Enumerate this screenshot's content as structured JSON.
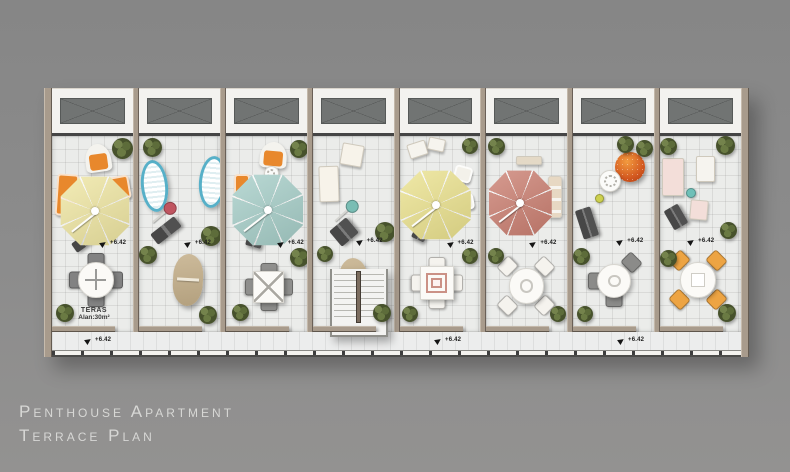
{
  "title": {
    "line1": "Penthouse Apartment",
    "line2": "Terrace Plan"
  },
  "elevation_label": "+6.42",
  "area_label": {
    "line1": "TERAS",
    "line2": "Alan:30m²"
  },
  "palette": {
    "background": "#8c8c8c",
    "wall": "#a89b8c",
    "floor": "#ebecea",
    "window": "#717473",
    "umbrella_yellow": "#efe6a2",
    "umbrella_teal": "#a6cec8",
    "umbrella_yellow2": "#ebe28e",
    "umbrella_salmon": "#cb7f71",
    "orange_furniture": "#e8882c",
    "sunbed_teal": "#57b0c8",
    "bench_gray": "#4f4f4f",
    "plant_green": "#47522c",
    "title_text": "#d7d7d5"
  },
  "walkway": {
    "markers": [
      {
        "x": 33
      },
      {
        "x": 383
      },
      {
        "x": 566
      }
    ]
  },
  "units": [
    {
      "name": "terrace-unit-1",
      "items": [
        {
          "type": "hooded",
          "name": "hooded-beach-chair",
          "x": 33,
          "y": 8,
          "w": 26,
          "h": 28,
          "rot": -8,
          "c": "#e8882c"
        },
        {
          "type": "plant",
          "name": "potted-plant",
          "x": 60,
          "y": 2,
          "w": 21,
          "h": 21
        },
        {
          "type": "chair",
          "name": "lounge-sofa",
          "x": 4,
          "y": 38,
          "w": 22,
          "h": 42,
          "rot": 4,
          "c": "#e8882c"
        },
        {
          "type": "chair",
          "name": "lounge-chair",
          "x": 58,
          "y": 40,
          "w": 20,
          "h": 24,
          "rot": -10,
          "c": "#e8882c"
        },
        {
          "type": "umbrella",
          "name": "patio-umbrella",
          "x": 8,
          "y": 40,
          "w": 70,
          "h": 70,
          "c": "#efe6a2"
        },
        {
          "type": "bench",
          "name": "bench",
          "x": 20,
          "y": 100,
          "w": 24,
          "h": 11,
          "rot": -35
        },
        {
          "type": "elev",
          "name": "elevation-marker",
          "x": 48,
          "y": 104,
          "label": "+6.42"
        },
        {
          "type": "table",
          "name": "dining-table-set",
          "shape": "round",
          "x": 18,
          "y": 118,
          "w": 52,
          "h": 52,
          "deco": "cross",
          "cc": "#828282",
          "chairs": [
            "n",
            "e",
            "s",
            "w"
          ]
        },
        {
          "type": "arealabel",
          "name": "area-label",
          "x": 18,
          "y": 171,
          "lines": [
            "TERAS",
            "Alan:30m²"
          ]
        },
        {
          "type": "plant",
          "name": "potted-plant",
          "x": 4,
          "y": 168,
          "w": 18,
          "h": 18
        }
      ]
    },
    {
      "name": "terrace-unit-2",
      "items": [
        {
          "type": "plant",
          "name": "potted-plant",
          "x": 4,
          "y": 2,
          "w": 19,
          "h": 19
        },
        {
          "type": "sunbed",
          "name": "sun-lounger",
          "x": 2,
          "y": 24,
          "w": 27,
          "h": 52,
          "rot": -6,
          "c": "#57b0c8"
        },
        {
          "type": "sunbed",
          "name": "sun-lounger",
          "x": 60,
          "y": 20,
          "w": 27,
          "h": 52,
          "rot": 5,
          "c": "#57b0c8"
        },
        {
          "type": "stand",
          "name": "parasol-stand",
          "x": 8,
          "y": 70,
          "w": 24,
          "h": 2,
          "rot": -40,
          "c": "#c05560"
        },
        {
          "type": "bench",
          "name": "bench",
          "x": 12,
          "y": 88,
          "w": 30,
          "h": 13,
          "rot": -38
        },
        {
          "type": "elev",
          "name": "elevation-marker",
          "x": 46,
          "y": 104,
          "label": "+6.42"
        },
        {
          "type": "plant",
          "name": "potted-plant",
          "x": 62,
          "y": 90,
          "w": 20,
          "h": 20
        },
        {
          "type": "plant",
          "name": "potted-plant",
          "x": 0,
          "y": 110,
          "w": 18,
          "h": 18
        },
        {
          "type": "board",
          "name": "surf-lounger",
          "x": 34,
          "y": 118,
          "w": 30,
          "h": 52,
          "rot": 3
        },
        {
          "type": "plant",
          "name": "potted-plant",
          "x": 60,
          "y": 170,
          "w": 18,
          "h": 18
        }
      ]
    },
    {
      "name": "terrace-unit-3",
      "items": [
        {
          "type": "hooded",
          "name": "hooded-beach-chair",
          "x": 34,
          "y": 6,
          "w": 27,
          "h": 26,
          "rot": 5,
          "c": "#e8882c"
        },
        {
          "type": "plant",
          "name": "potted-plant",
          "x": 64,
          "y": 4,
          "w": 18,
          "h": 18
        },
        {
          "type": "chair",
          "name": "lounge-chair",
          "x": 8,
          "y": 38,
          "w": 16,
          "h": 26,
          "c": "#e8882c"
        },
        {
          "type": "flowertable",
          "name": "side-table",
          "x": 38,
          "y": 30,
          "w": 15,
          "h": 15
        },
        {
          "type": "umbrella",
          "name": "patio-umbrella",
          "x": 6,
          "y": 38,
          "w": 72,
          "h": 72,
          "c": "#a6cec8"
        },
        {
          "type": "bench",
          "name": "bench",
          "x": 20,
          "y": 102,
          "w": 16,
          "h": 9,
          "rot": 15
        },
        {
          "type": "elev",
          "name": "elevation-marker",
          "x": 52,
          "y": 104,
          "label": "+6.42"
        },
        {
          "type": "plant",
          "name": "potted-plant",
          "x": 64,
          "y": 112,
          "w": 19,
          "h": 19
        },
        {
          "type": "table",
          "name": "dining-table-set",
          "shape": "square",
          "x": 20,
          "y": 128,
          "w": 46,
          "h": 46,
          "deco": "x",
          "cc": "#8f8f8d",
          "chairs": [
            "n",
            "e",
            "s",
            "w"
          ]
        },
        {
          "type": "plant",
          "name": "potted-plant",
          "x": 6,
          "y": 168,
          "w": 17,
          "h": 17
        }
      ]
    },
    {
      "name": "terrace-unit-4",
      "items": [
        {
          "type": "mat",
          "name": "lounger-mat",
          "x": 28,
          "y": 8,
          "w": 22,
          "h": 22,
          "rot": 10,
          "c": "#f7f3ea"
        },
        {
          "type": "mat",
          "name": "lounger-mat",
          "x": 6,
          "y": 30,
          "w": 20,
          "h": 36,
          "rot": -2,
          "c": "#f7f3ea"
        },
        {
          "type": "stand",
          "name": "parasol-stand",
          "x": 16,
          "y": 68,
          "w": 24,
          "h": 2,
          "rot": -42,
          "c": "#79bdb4"
        },
        {
          "type": "bench",
          "name": "bench",
          "x": 20,
          "y": 86,
          "w": 22,
          "h": 20,
          "rot": -40
        },
        {
          "type": "elev",
          "name": "elevation-marker",
          "x": 44,
          "y": 102,
          "label": "+6.42"
        },
        {
          "type": "plant",
          "name": "potted-plant",
          "x": 4,
          "y": 110,
          "w": 16,
          "h": 16
        },
        {
          "type": "plant",
          "name": "potted-plant",
          "x": 62,
          "y": 86,
          "w": 20,
          "h": 20
        },
        {
          "type": "board",
          "name": "surf-lounger",
          "x": 26,
          "y": 122,
          "w": 30,
          "h": 54,
          "rot": -4
        },
        {
          "type": "plant",
          "name": "potted-plant",
          "x": 60,
          "y": 168,
          "w": 18,
          "h": 18
        }
      ]
    },
    {
      "name": "terrace-unit-5",
      "items": [
        {
          "type": "mat",
          "name": "lounger-mat",
          "x": 8,
          "y": 6,
          "w": 19,
          "h": 15,
          "rot": -18,
          "c": "#f6f4ee"
        },
        {
          "type": "mat",
          "name": "lounger-mat",
          "x": 28,
          "y": 2,
          "w": 17,
          "h": 13,
          "rot": 12,
          "c": "#f6f4ee"
        },
        {
          "type": "plant",
          "name": "potted-plant",
          "x": 62,
          "y": 2,
          "w": 16,
          "h": 16
        },
        {
          "type": "chair",
          "name": "patio-chair",
          "x": 54,
          "y": 30,
          "w": 18,
          "h": 16,
          "rot": 15,
          "c": "#f3f1ea"
        },
        {
          "type": "umbrella",
          "name": "patio-umbrella",
          "x": 0,
          "y": 34,
          "w": 72,
          "h": 70,
          "c": "#ebe28e"
        },
        {
          "type": "chair",
          "name": "patio-chair",
          "x": 58,
          "y": 58,
          "w": 16,
          "h": 16,
          "rot": -10,
          "c": "#f3f1ea"
        },
        {
          "type": "bench",
          "name": "bench",
          "x": 12,
          "y": 96,
          "w": 14,
          "h": 8,
          "rot": 25
        },
        {
          "type": "elev",
          "name": "elevation-marker",
          "x": 48,
          "y": 104,
          "label": "+6.42"
        },
        {
          "type": "plant",
          "name": "potted-plant",
          "x": 62,
          "y": 112,
          "w": 16,
          "h": 16
        },
        {
          "type": "table",
          "name": "dining-table-set",
          "shape": "square",
          "x": 12,
          "y": 122,
          "w": 50,
          "h": 50,
          "deco": "squares",
          "cc": "#f5f3ee",
          "chairs": [
            "n",
            "e",
            "s",
            "w"
          ]
        },
        {
          "type": "plant",
          "name": "potted-plant",
          "x": 2,
          "y": 170,
          "w": 16,
          "h": 16
        }
      ]
    },
    {
      "name": "terrace-unit-6",
      "items": [
        {
          "type": "plant",
          "name": "potted-plant",
          "x": 2,
          "y": 2,
          "w": 17,
          "h": 17
        },
        {
          "type": "mat",
          "name": "shelf-bench",
          "x": 30,
          "y": 20,
          "w": 26,
          "h": 9,
          "c": "#e4d9c6"
        },
        {
          "type": "umbrella",
          "name": "patio-umbrella",
          "x": 2,
          "y": 34,
          "w": 64,
          "h": 66,
          "c": "#cb7f71"
        },
        {
          "type": "lounge",
          "name": "cushion-bench",
          "x": 62,
          "y": 40,
          "w": 14,
          "h": 42
        },
        {
          "type": "elev",
          "name": "elevation-marker",
          "x": 44,
          "y": 104,
          "label": "+6.42"
        },
        {
          "type": "plant",
          "name": "potted-plant",
          "x": 2,
          "y": 112,
          "w": 16,
          "h": 16
        },
        {
          "type": "table",
          "name": "dining-table-set",
          "shape": "round",
          "x": 14,
          "y": 124,
          "w": 52,
          "h": 52,
          "deco": "ring",
          "cc": "#f5f3ee",
          "chairs": [
            "ne",
            "se",
            "sw",
            "nw"
          ]
        },
        {
          "type": "plant",
          "name": "potted-plant",
          "x": 64,
          "y": 170,
          "w": 16,
          "h": 16
        }
      ]
    },
    {
      "name": "terrace-unit-7",
      "items": [
        {
          "type": "plant",
          "name": "potted-plant",
          "x": 44,
          "y": 0,
          "w": 17,
          "h": 17
        },
        {
          "type": "plant",
          "name": "potted-plant",
          "x": 63,
          "y": 4,
          "w": 17,
          "h": 17
        },
        {
          "type": "papasan",
          "name": "papasan-chair",
          "x": 42,
          "y": 16,
          "w": 30,
          "h": 30
        },
        {
          "type": "flowertable",
          "name": "round-side-table",
          "x": 26,
          "y": 34,
          "w": 22,
          "h": 22
        },
        {
          "type": "dot",
          "name": "watering-can",
          "x": 22,
          "y": 58,
          "w": 9,
          "h": 9,
          "c": "#cdd04e"
        },
        {
          "type": "bench",
          "name": "bench",
          "x": 6,
          "y": 72,
          "w": 16,
          "h": 30,
          "rot": -18
        },
        {
          "type": "elev",
          "name": "elevation-marker",
          "x": 44,
          "y": 102,
          "label": "+6.42"
        },
        {
          "type": "plant",
          "name": "potted-plant",
          "x": 0,
          "y": 112,
          "w": 17,
          "h": 17
        },
        {
          "type": "table",
          "name": "dining-table-set",
          "shape": "round",
          "x": 16,
          "y": 120,
          "w": 50,
          "h": 50,
          "deco": "ring",
          "cc": "#8b8b89",
          "chairs": [
            "ne",
            "w",
            "s"
          ]
        },
        {
          "type": "plant",
          "name": "potted-plant",
          "x": 4,
          "y": 170,
          "w": 16,
          "h": 16
        }
      ]
    },
    {
      "name": "terrace-unit-8",
      "items": [
        {
          "type": "plant",
          "name": "potted-plant",
          "x": 0,
          "y": 2,
          "w": 17,
          "h": 17
        },
        {
          "type": "plant",
          "name": "potted-plant",
          "x": 56,
          "y": 0,
          "w": 19,
          "h": 19
        },
        {
          "type": "mat",
          "name": "patterned-mat",
          "x": 2,
          "y": 22,
          "w": 22,
          "h": 38,
          "c": "#f3ded9"
        },
        {
          "type": "mat",
          "name": "lounger-mat",
          "x": 36,
          "y": 20,
          "w": 19,
          "h": 26,
          "c": "#f6f4ef"
        },
        {
          "type": "dot",
          "name": "watering-can",
          "x": 26,
          "y": 52,
          "w": 10,
          "h": 10,
          "c": "#6fc0b8"
        },
        {
          "type": "bench",
          "name": "bench",
          "x": 8,
          "y": 70,
          "w": 16,
          "h": 22,
          "rot": -30
        },
        {
          "type": "mat",
          "name": "patterned-mat",
          "x": 30,
          "y": 64,
          "w": 18,
          "h": 20,
          "rot": 5,
          "c": "#f3ded9"
        },
        {
          "type": "plant",
          "name": "potted-plant",
          "x": 60,
          "y": 86,
          "w": 17,
          "h": 17
        },
        {
          "type": "elev",
          "name": "elevation-marker",
          "x": 28,
          "y": 102,
          "label": "+6.42"
        },
        {
          "type": "plant",
          "name": "potted-plant",
          "x": 0,
          "y": 114,
          "w": 17,
          "h": 17
        },
        {
          "type": "table",
          "name": "dining-table-set",
          "shape": "round",
          "x": 12,
          "y": 118,
          "w": 52,
          "h": 52,
          "deco": "square",
          "cc": "#eda443",
          "chairs": [
            "ne",
            "se",
            "sw",
            "nw"
          ]
        },
        {
          "type": "plant",
          "name": "potted-plant",
          "x": 58,
          "y": 168,
          "w": 18,
          "h": 18
        }
      ]
    }
  ]
}
